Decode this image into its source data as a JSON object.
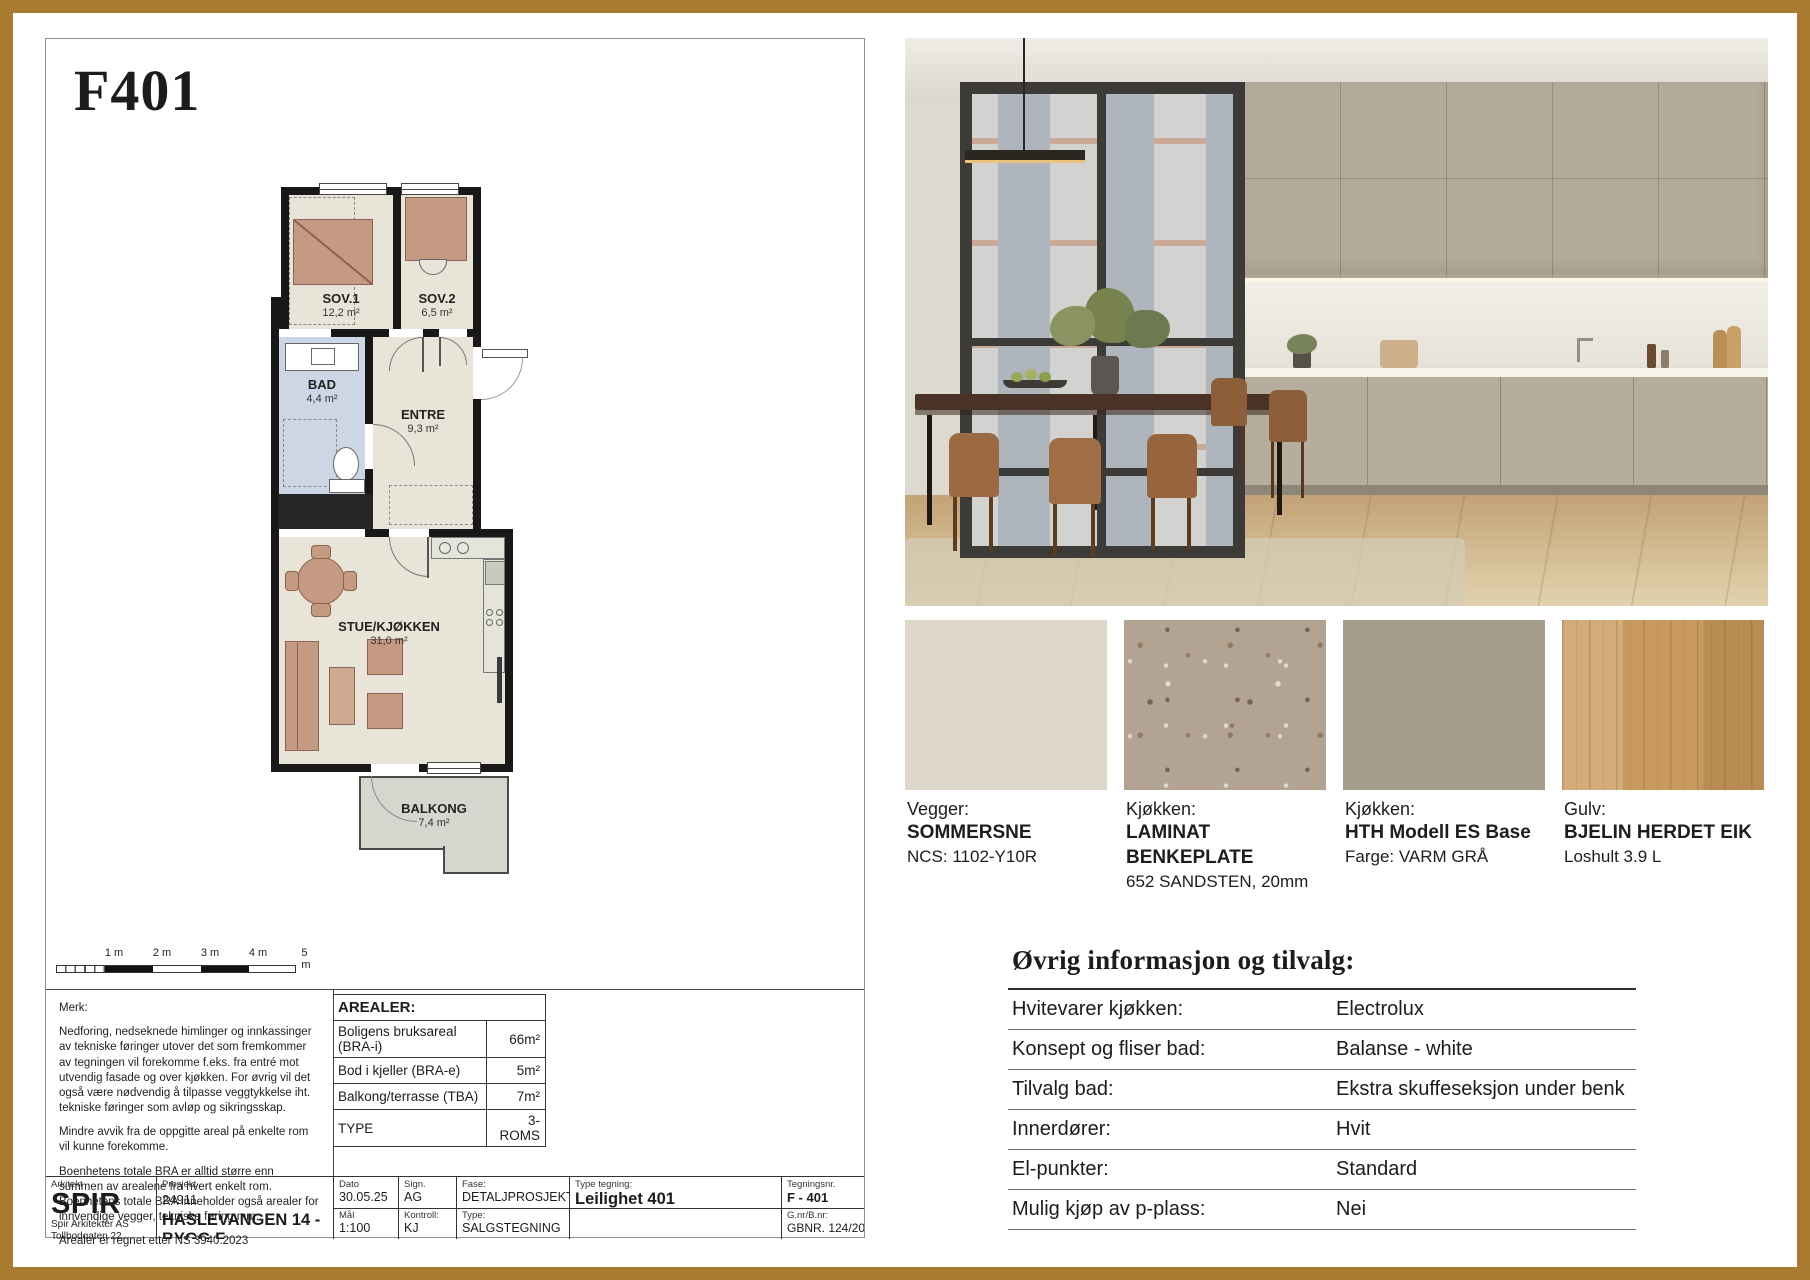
{
  "theme": {
    "frame_color": "#a97b31",
    "swatch_colors": [
      "#ddd8ca",
      "#b2a392",
      "#a59d8c",
      "#c89a5e"
    ]
  },
  "sheet": {
    "title": "F401",
    "rooms": {
      "sov1": {
        "name": "SOV.1",
        "area": "12,2 m²"
      },
      "sov2": {
        "name": "SOV.2",
        "area": "6,5 m²"
      },
      "bad": {
        "name": "BAD",
        "area": "4,4 m²"
      },
      "entre": {
        "name": "ENTRE",
        "area": "9,3 m²"
      },
      "stue": {
        "name": "STUE/KJØKKEN",
        "area": "31,0 m²"
      },
      "balkong": {
        "name": "BALKONG",
        "area": "7,4 m²"
      }
    },
    "scale_labels": [
      "1 m",
      "2 m",
      "3 m",
      "4 m",
      "5 m"
    ],
    "notes": {
      "heading": "Merk:",
      "p1": "Nedforing, nedseknede himlinger og innkassinger av tekniske føringer utover det som fremkommer av tegningen vil forekomme f.eks. fra entré mot utvendig fasade og over kjøkken. For øvrig vil det også være nødvendig å tilpasse veggtykkelse iht. tekniske føringer som avløp og sikringsskap.",
      "p2": "Mindre avvik fra de oppgitte areal på enkelte rom vil kunne forekomme.",
      "p3": "Boenhetens totale BRA er alltid større enn summen av arealene fra hvert enkelt rom. Boenhetens totale BRA inneholder også arealer for innvendige vegger, tekniske føring mm.",
      "p4": "Arealer er regnet etter NS 3940:2023"
    },
    "arealer": {
      "heading": "AREALER:",
      "rows": [
        {
          "label": "Boligens bruksareal (BRA-i)",
          "value": "66m²"
        },
        {
          "label": "Bod i kjeller (BRA-e)",
          "value": "5m²"
        },
        {
          "label": "Balkong/terrasse (TBA)",
          "value": "7m²"
        },
        {
          "label": "TYPE",
          "value": "3-ROMS"
        }
      ]
    },
    "titleblock": {
      "arkitekt_label": "Arkitekt",
      "logo": "SPIR",
      "addr1": "Spir Arkitekter AS",
      "addr2": "Tollbodgaten 22,",
      "addr3": "3111 Tønsberg",
      "prosjekt_label": "Prosjekt",
      "prosjekt_nr": "24911",
      "prosjekt_navn": "HASLEVANGEN 14 - BYGG F",
      "dato_label": "Dato",
      "dato": "30.05.25",
      "sign_label": "Sign.",
      "sign": "AG",
      "fase_label": "Fase:",
      "fase": "DETALJPROSJEKT",
      "type_tegning_label": "Type tegning:",
      "type_tegning": "Leilighet 401",
      "tegningsnr_label": "Tegningsnr.",
      "tegningsnr": "F - 401",
      "maal_label": "Mål",
      "maal": "1:100",
      "kontroll_label": "Kontroll:",
      "kontroll": "KJ",
      "type_label": "Type:",
      "type": "SALGSTEGNING",
      "gnr_label": "G.nr/B.nr:",
      "gnr": "GBNR. 124/202"
    }
  },
  "materials": [
    {
      "category": "Vegger:",
      "name": "SOMMERSNE",
      "detail": "NCS: 1102-Y10R"
    },
    {
      "category": "Kjøkken:",
      "name": "LAMINAT BENKEPLATE",
      "detail": "652 SANDSTEN, 20mm"
    },
    {
      "category": "Kjøkken:",
      "name": "HTH Modell ES Base",
      "detail": "Farge: VARM GRÅ"
    },
    {
      "category": "Gulv:",
      "name": "BJELIN HERDET EIK",
      "detail": "Loshult 3.9 L"
    }
  ],
  "info_table": {
    "title": "Øvrig informasjon og tilvalg:",
    "rows": [
      {
        "label": "Hvitevarer kjøkken:",
        "value": "Electrolux"
      },
      {
        "label": "Konsept og fliser bad:",
        "value": "Balanse - white"
      },
      {
        "label": "Tilvalg bad:",
        "value": "Ekstra skuffeseksjon under benk"
      },
      {
        "label": "Innerdører:",
        "value": "Hvit"
      },
      {
        "label": "El-punkter:",
        "value": "Standard"
      },
      {
        "label": "Mulig kjøp av p-plass:",
        "value": "Nei"
      }
    ]
  }
}
